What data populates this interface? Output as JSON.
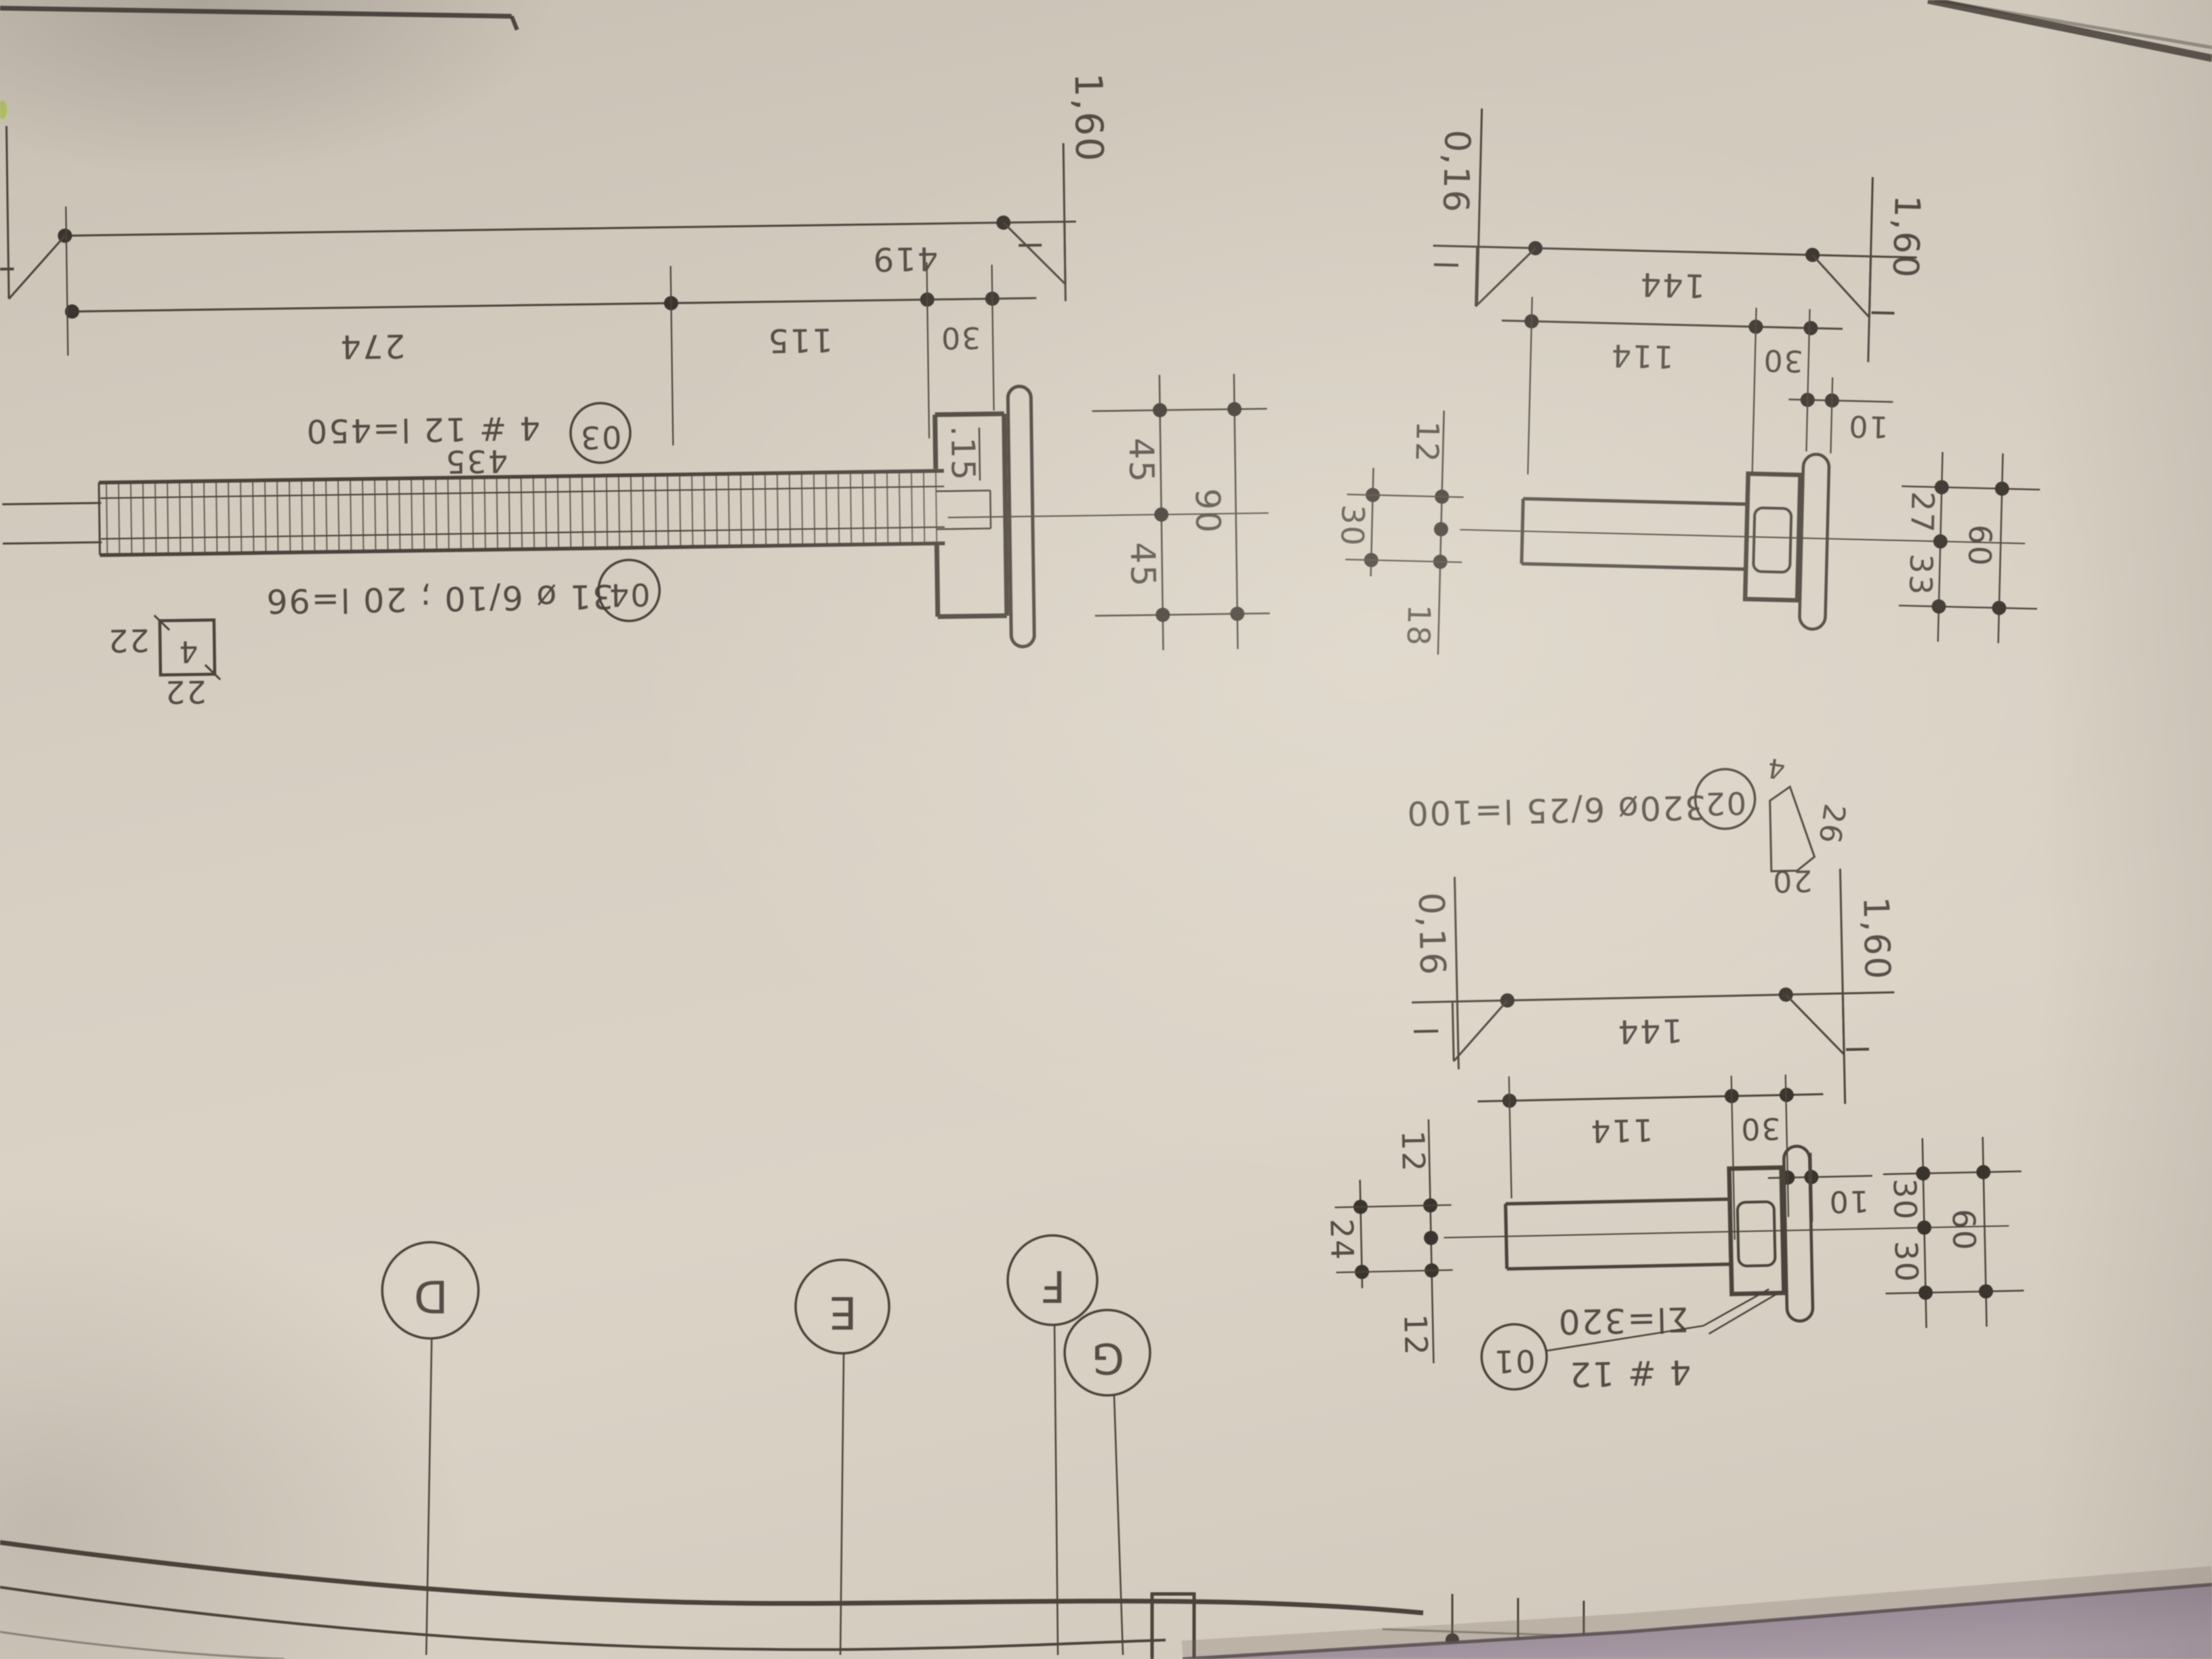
{
  "main": {
    "dim419": "419",
    "dim274": "274",
    "dim115": "115",
    "dim30": "30",
    "level_right": "1,60",
    "dim435": "435",
    "callout03_num": "03",
    "callout03_text": "4 # 12 l=450",
    "callout04_num": "04",
    "callout04_text": "31 ø 6/10 ; 20 l=96",
    "depth15": ".15",
    "dim45_upper": "45",
    "dim45_lower": "45",
    "dim90": "90",
    "stirrup_mark": "4",
    "stirrup_dim_side": "22",
    "stirrup_dim_bottom": "22"
  },
  "detail1": {
    "level_left": "0,16",
    "level_right": "1,60",
    "dim144": "144",
    "dim114": "114",
    "dim30": "30",
    "dim10": "10",
    "dim12": "12",
    "dim18": "18",
    "dim30_total": "30",
    "dim27": "27",
    "dim33": "33",
    "dim60": "60"
  },
  "detail2": {
    "level_left": "0,16",
    "level_right": "1,60",
    "dim144": "144",
    "dim114": "114",
    "dim30": "30",
    "dim10": "10",
    "dim12_top": "12",
    "dim24": "24",
    "dim12_bottom": "12",
    "dim30_top": "30",
    "dim30_bottom": "30",
    "dim60": "60",
    "callout01_num": "01",
    "callout01_sum": "Σl=320",
    "callout01_bars": "4 # 12"
  },
  "callout02": {
    "num": "02",
    "text": "320ø 6/25 l=100",
    "hook_top": "4",
    "hook_side": "26",
    "hook_bottom": "20"
  },
  "grid_bubbles": {
    "d": "D",
    "e": "E",
    "f": "F",
    "g": "G"
  }
}
